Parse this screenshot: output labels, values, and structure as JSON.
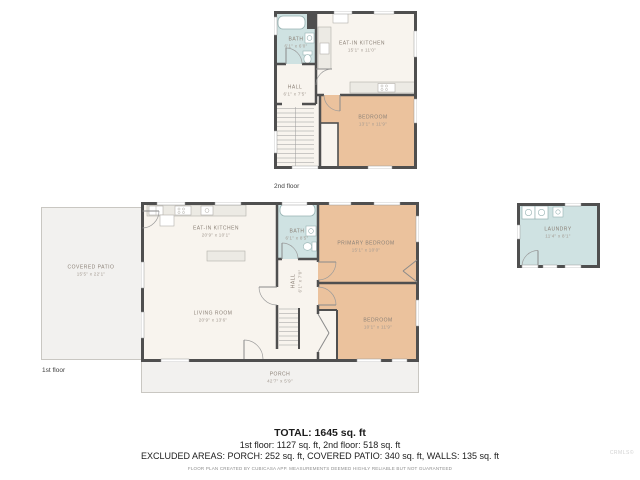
{
  "title_block": {
    "total": "TOTAL: 1645 sq. ft",
    "floors": "1st floor: 1127 sq. ft, 2nd floor: 518 sq. ft",
    "excluded": "EXCLUDED AREAS: PORCH: 252 sq. ft, COVERED PATIO: 340 sq. ft, WALLS: 135 sq. ft",
    "disclaimer": "FLOOR PLAN CREATED BY CUBICASA APP. MEASUREMENTS DEEMED HIGHLY RELIABLE BUT NOT GUARANTEED",
    "watermark": "CRMLS©"
  },
  "floor2": {
    "tag": "2nd floor",
    "bath": {
      "name": "BATH",
      "dims": "6'1\" x 6'0\""
    },
    "kitchen": {
      "name": "EAT-IN KITCHEN",
      "dims": "15'1\" x 11'0\""
    },
    "hall": {
      "name": "HALL",
      "dims": "6'1\" x 7'5\""
    },
    "bedroom": {
      "name": "BEDROOM",
      "dims": "13'1\" x 11'9\""
    }
  },
  "floor1": {
    "tag": "1st floor",
    "kitchen": {
      "name": "EAT-IN KITCHEN",
      "dims": "20'9\" x 10'1\""
    },
    "living": {
      "name": "LIVING ROOM",
      "dims": "20'9\" x 13'6\""
    },
    "bath": {
      "name": "BATH",
      "dims": "6'1\" x 8'5\""
    },
    "hall": {
      "name": "HALL",
      "dims": "6'1\" x 7'0\""
    },
    "primary": {
      "name": "PRIMARY BEDROOM",
      "dims": "15'1\" x 10'0\""
    },
    "bedroom": {
      "name": "BEDROOM",
      "dims": "10'1\" x 11'9\""
    },
    "patio": {
      "name": "COVERED PATIO",
      "dims": "15'5\" x 22'1\""
    },
    "porch": {
      "name": "PORCH",
      "dims": "42'7\" x 5'9\""
    }
  },
  "laundry": {
    "name": "LAUNDRY",
    "dims": "11'4\" x 8'1\""
  },
  "colors": {
    "wall": "#4f4f4f",
    "room": "#f8f4ee",
    "bedroom": "#ebc29d",
    "wet": "#cfe2e2",
    "outdoor": "#f2f1ef"
  }
}
